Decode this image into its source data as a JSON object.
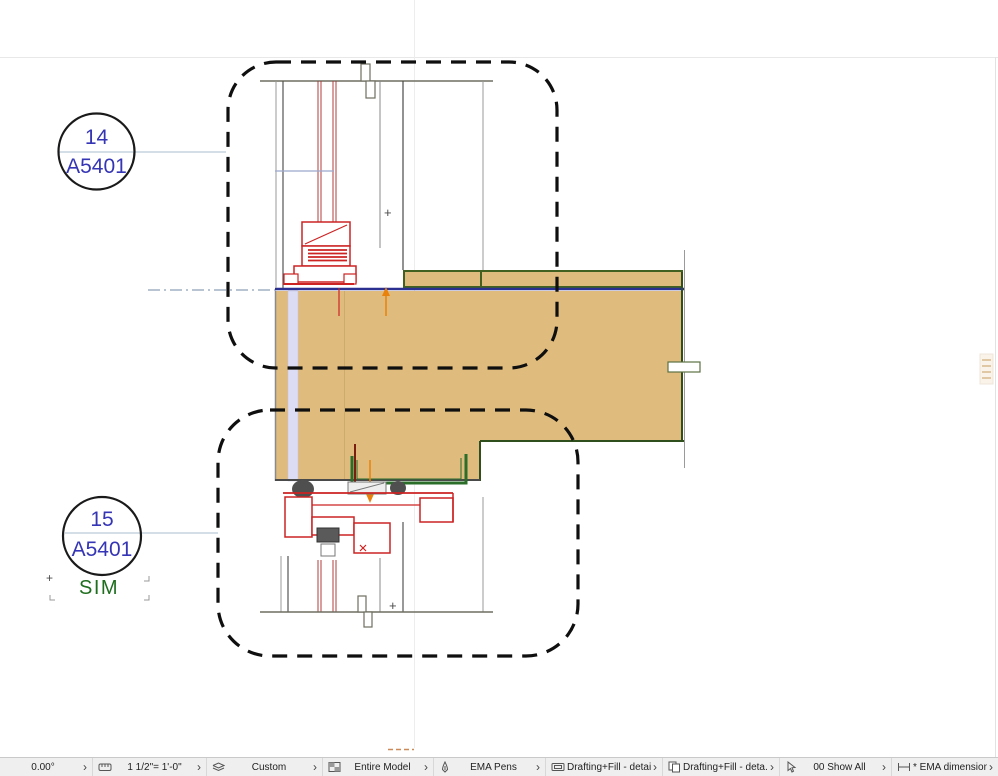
{
  "callouts": {
    "top": {
      "number": "14",
      "sheet": "A5401"
    },
    "bottom": {
      "number": "15",
      "sheet": "A5401",
      "modifier": "SIM"
    }
  },
  "drawing": {
    "plus_mark": "+",
    "colors": {
      "callout_text": "#3535b5",
      "sim_green": "#1e6e1e",
      "slab_tan": "#dfbb7e",
      "detail_red": "#cc2323",
      "channel_green": "#2a6e2a",
      "navy_line": "#2b2f8f",
      "orange_marker": "#e8820c",
      "lavender_strip": "#dcdcf4",
      "boundary_dash": "#0f0f0f"
    }
  },
  "statusbar": {
    "chevron": "›",
    "items": [
      {
        "icon": "none",
        "label": "0.00°"
      },
      {
        "icon": "ruler",
        "label": "1 1/2\"=  1'-0\""
      },
      {
        "icon": "layers",
        "label": "Custom"
      },
      {
        "icon": "grid",
        "label": "Entire Model"
      },
      {
        "icon": "pen",
        "label": "EMA Pens"
      },
      {
        "icon": "frame",
        "label": "Drafting+Fill - detail"
      },
      {
        "icon": "copy",
        "label": "Drafting+Fill - deta..."
      },
      {
        "icon": "layer-cursor",
        "label": "00 Show All"
      },
      {
        "icon": "dimension",
        "label": "* EMA dimensions"
      }
    ]
  }
}
